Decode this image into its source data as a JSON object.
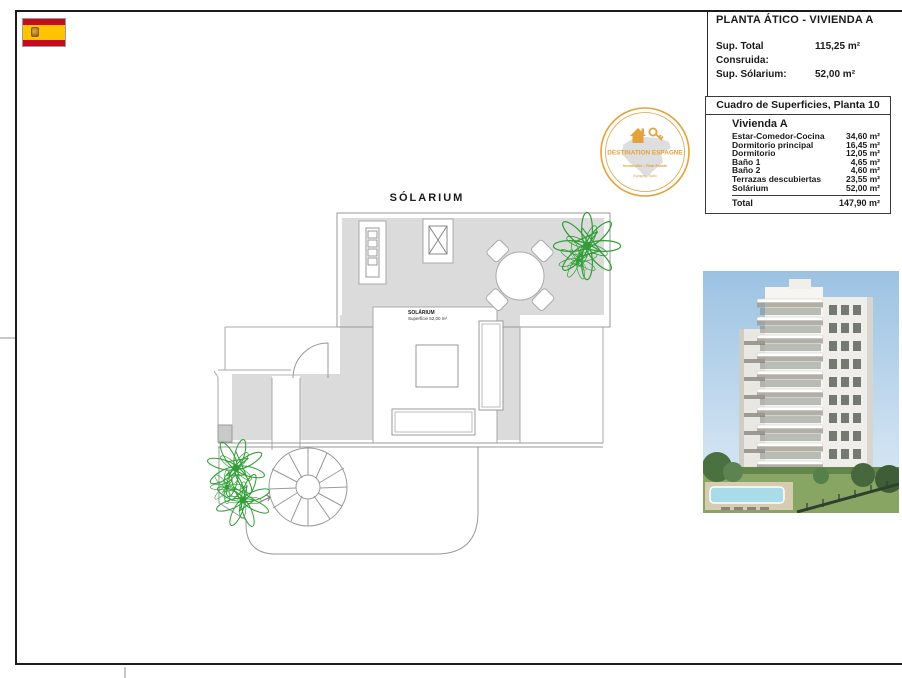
{
  "header": {
    "title": "PLANTA ÁTICO - VIVIENDA A",
    "fields": [
      {
        "label": "Sup. Total Consruida:",
        "value": "115,25 m²"
      },
      {
        "label": "Sup. Sólarium:",
        "value": "52,00 m²"
      }
    ]
  },
  "surfaces_table": {
    "title": "Cuadro de Superficies, Planta 10",
    "subtitle": "Vivienda A",
    "rows": [
      {
        "label": "Estar-Comedor-Cocina",
        "value": "34,60 m²"
      },
      {
        "label": "Dormitorio principal",
        "value": "16,45 m²"
      },
      {
        "label": "Dormitorio",
        "value": "12,05 m²"
      },
      {
        "label": "Baño 1",
        "value": "4,65 m²"
      },
      {
        "label": "Baño 2",
        "value": "4,60 m²"
      },
      {
        "label": "Terrazas descubiertas",
        "value": "23,55 m²"
      },
      {
        "label": "Solárium",
        "value": "52,00 m²"
      }
    ],
    "total": {
      "label": "Total",
      "value": "147,90 m²"
    }
  },
  "logo": {
    "line1": "DESTINATION ESPAGNE",
    "line2": "Immobilier - Real Estate",
    "line3": "Espagne - Spain",
    "accent_color": "#E2A23C"
  },
  "floor_plan": {
    "area_label": "SÓLARIUM",
    "room_label": "SOLÁRIUM",
    "room_sublabel": "Superficie 52,00 m²",
    "colors": {
      "terrace_fill": "#dbdbdb",
      "outline": "#9a9a9a",
      "plant_green": "#2f9e35"
    }
  },
  "flag": {
    "red": "#c60b1e",
    "yellow": "#ffc400"
  }
}
